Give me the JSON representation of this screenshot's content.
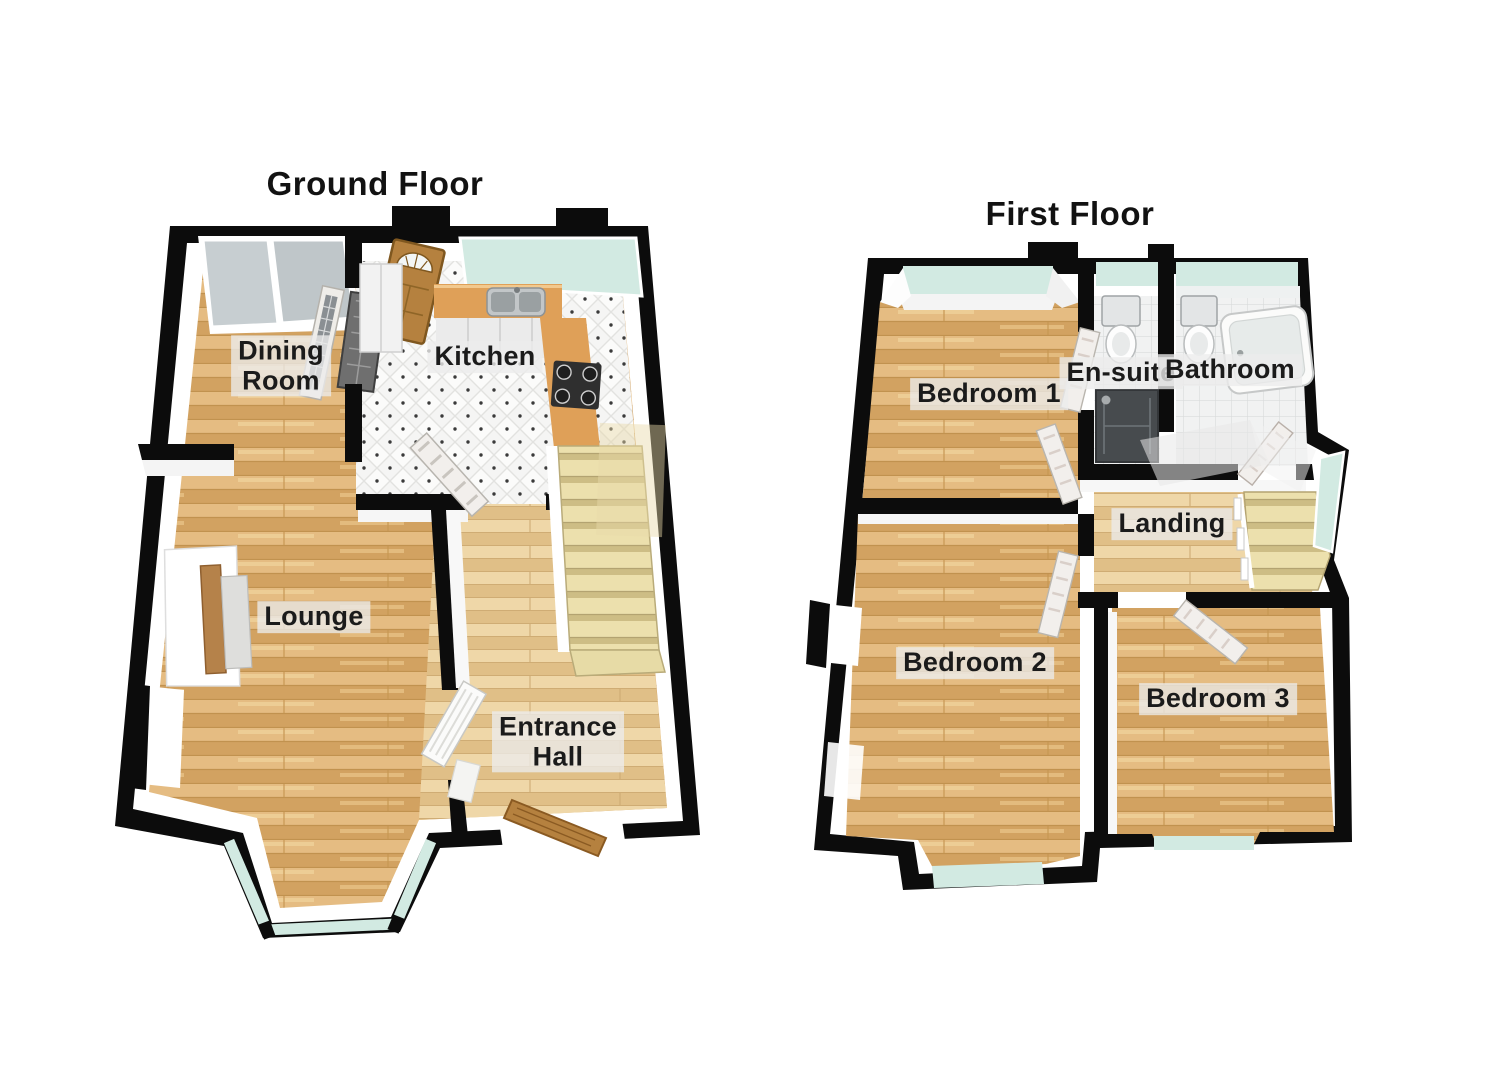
{
  "canvas": {
    "width": 1485,
    "height": 1080,
    "background": "#ffffff"
  },
  "ground_floor": {
    "title": "Ground Floor",
    "rooms": {
      "dining": {
        "label": "Dining\nRoom"
      },
      "kitchen": {
        "label": "Kitchen"
      },
      "lounge": {
        "label": "Lounge"
      },
      "entrance": {
        "label": "Entrance\nHall"
      }
    }
  },
  "first_floor": {
    "title": "First Floor",
    "rooms": {
      "bedroom1": {
        "label": "Bedroom 1"
      },
      "ensuite": {
        "label": "En-suite"
      },
      "bathroom": {
        "label": "Bathroom"
      },
      "landing": {
        "label": "Landing"
      },
      "bedroom2": {
        "label": "Bedroom 2"
      },
      "bedroom3": {
        "label": "Bedroom 3"
      }
    }
  },
  "colors": {
    "wall": "#0c0c0c",
    "wall_face": "#ffffff",
    "wood_floor": "#ddb074",
    "pale_wood": "#e9cd9b",
    "tile_white": "#f4f4f3",
    "glass": "#d2eae2",
    "counter": "#dfa058",
    "stairs": "#ece0ad",
    "door_wood": "#b5813f",
    "white_door": "#f2efec",
    "shower_dark": "#474b4e",
    "label_text": "#1b1b1b"
  }
}
